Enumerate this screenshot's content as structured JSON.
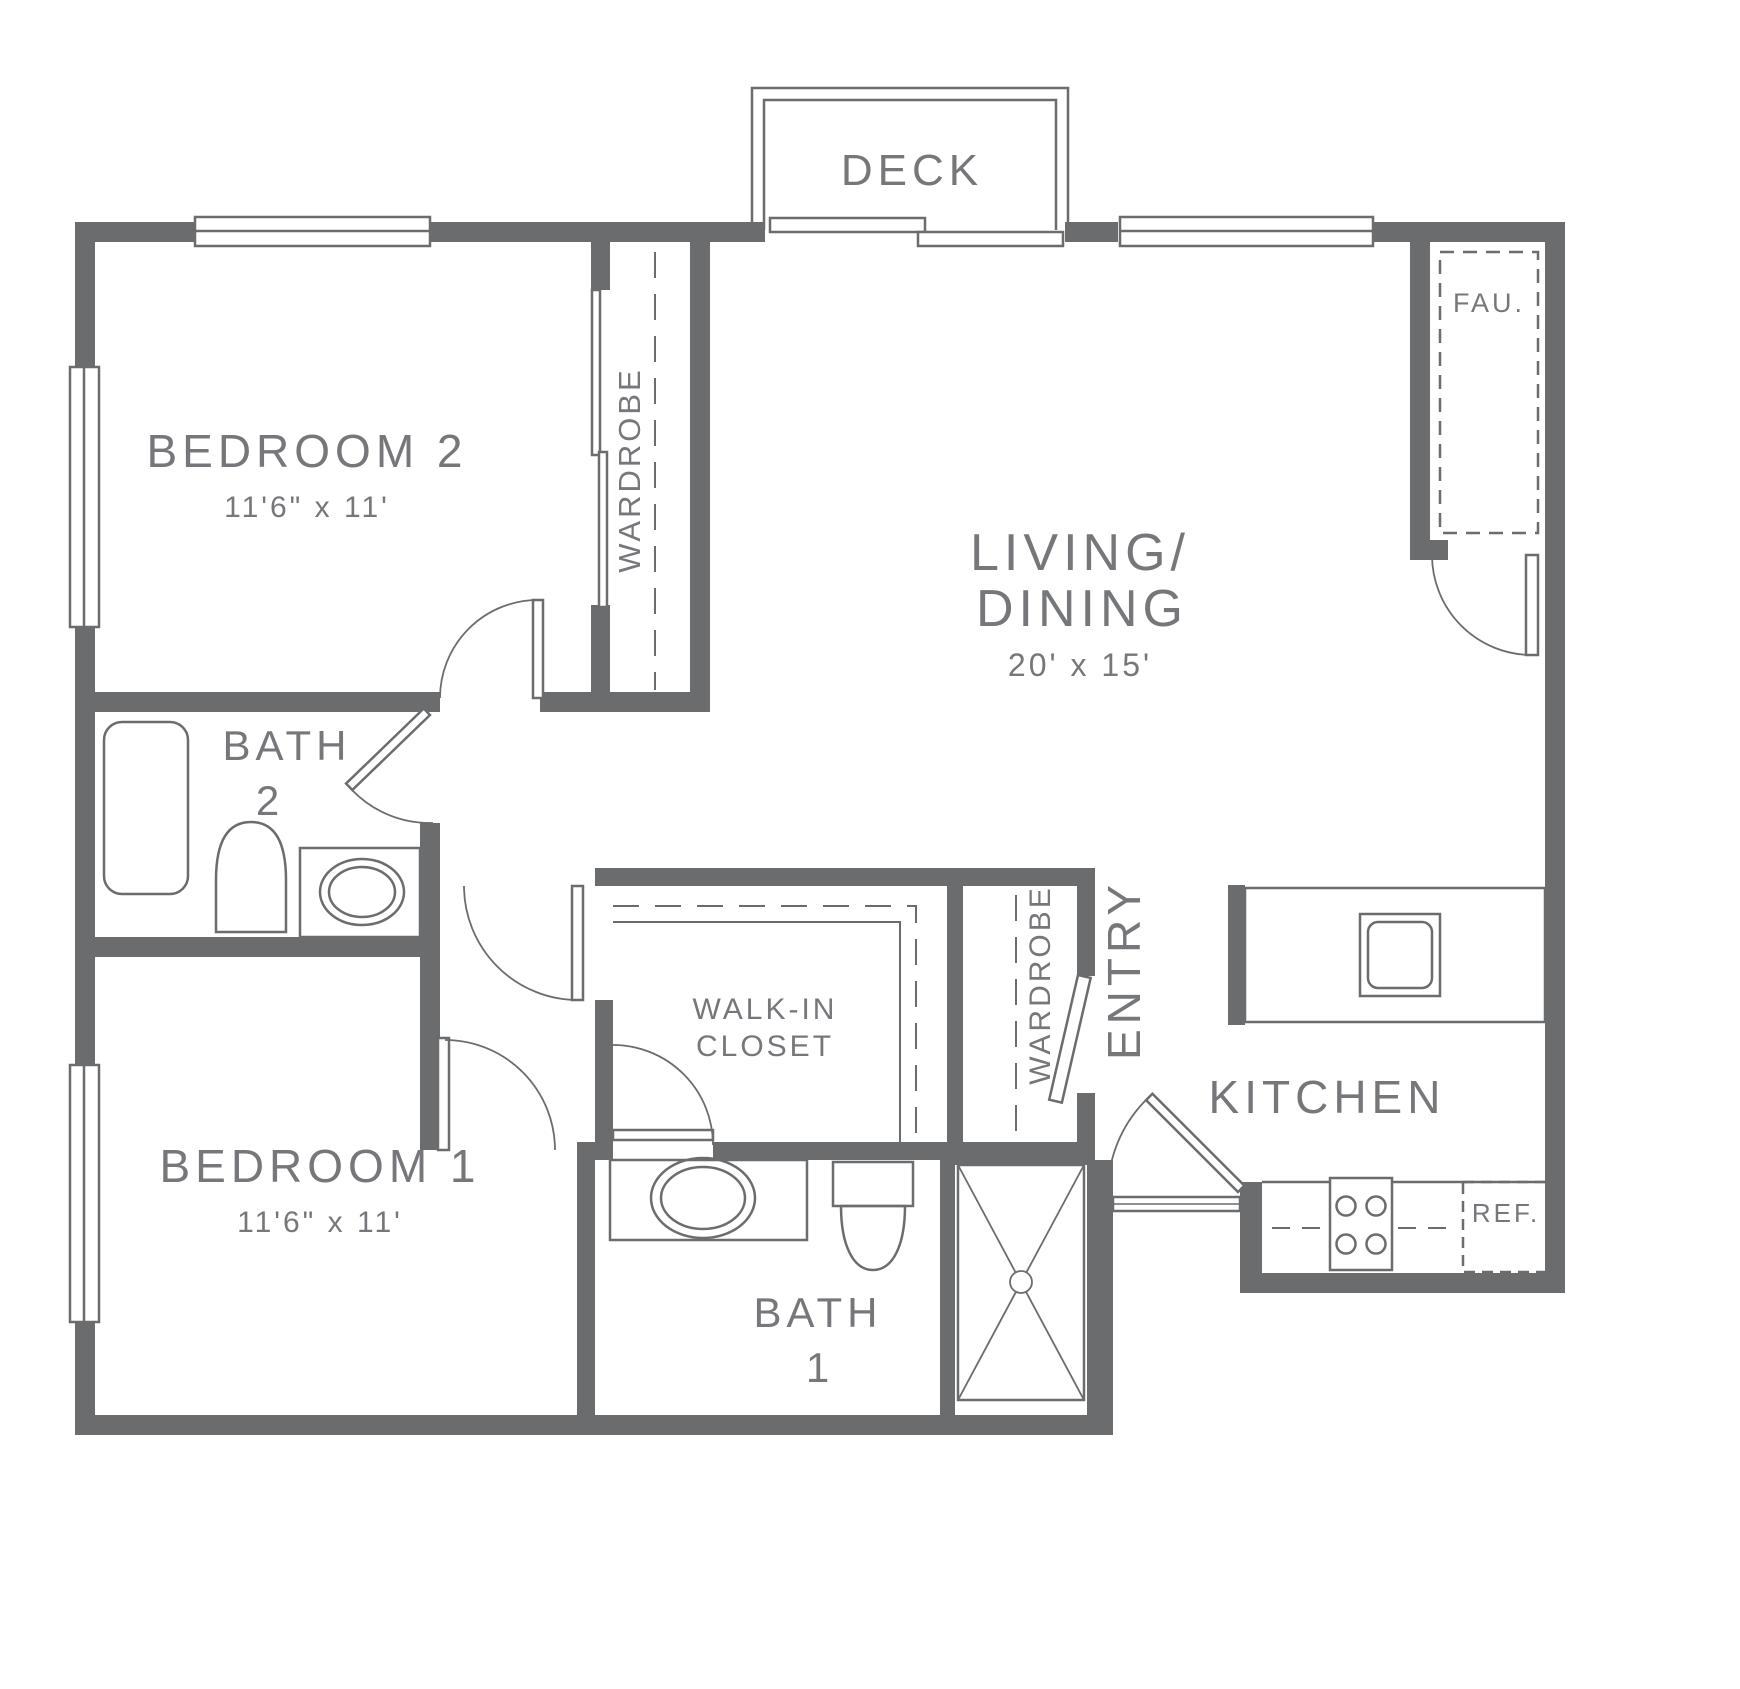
{
  "plan": {
    "title": "Two bedroom two bath apartment floor plan",
    "colors": {
      "wall": "#6a6c6e",
      "line": "#6a6c6e",
      "text": "#75777a"
    },
    "rooms": {
      "deck": {
        "label": "DECK"
      },
      "bedroom2": {
        "label": "BEDROOM 2",
        "dims": "11'6\" x 11'"
      },
      "living": {
        "label_line1": "LIVING/",
        "label_line2": "DINING",
        "dims": "20' x 15'"
      },
      "fau": {
        "label": "FAU."
      },
      "bath2": {
        "label_line1": "BATH",
        "label_line2": "2"
      },
      "walk_in_closet": {
        "label_line1": "WALK-IN",
        "label_line2": "CLOSET"
      },
      "bedroom1": {
        "label": "BEDROOM 1",
        "dims": "11'6\" x 11'"
      },
      "bath1": {
        "label_line1": "BATH",
        "label_line2": "1"
      },
      "kitchen": {
        "label": "KITCHEN"
      },
      "entry": {
        "label": "ENTRY"
      },
      "refrigerator": {
        "label": "REF."
      },
      "wardrobe_bedroom2": {
        "label": "WARDROBE"
      },
      "wardrobe_entry": {
        "label": "WARDROBE"
      }
    }
  }
}
